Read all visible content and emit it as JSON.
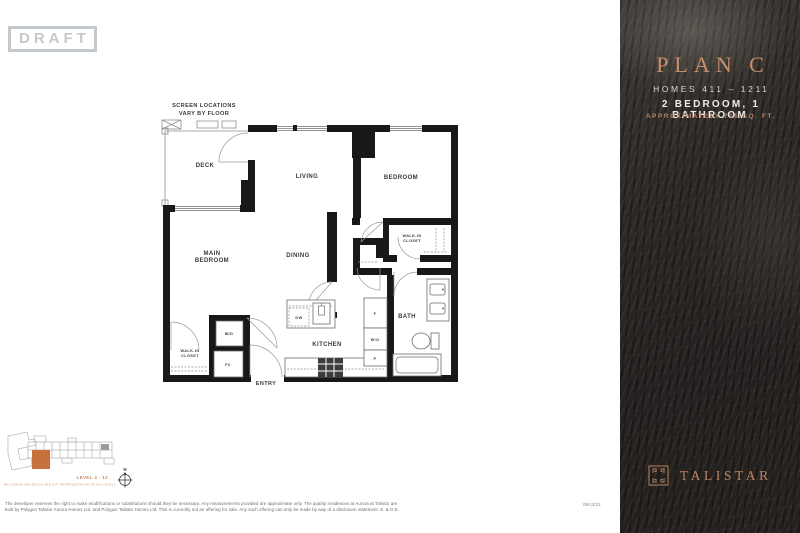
{
  "draft_label": "DRAFT",
  "colors": {
    "copper": "#C08463",
    "copper_bright": "#C98F6C",
    "unit_highlight": "#C8703C",
    "panel_bg": "#2B2825",
    "draft_gray": "#C4C9CD",
    "wall_black": "#181818"
  },
  "floorplan": {
    "note_line1": "SCREEN LOCATIONS",
    "note_line2": "VARY BY FLOOR",
    "labels": {
      "deck": "DECK",
      "living": "LIVING",
      "bedroom": "BEDROOM",
      "main_bedroom_1": "MAIN",
      "main_bedroom_2": "BEDROOM",
      "dining": "DINING",
      "kitchen": "KITCHEN",
      "bath": "BATH",
      "entry": "ENTRY",
      "walkin_bedroom_1": "WALK-IN",
      "walkin_bedroom_2": "CLOSET",
      "walkin_main_1": "WALK-IN",
      "walkin_main_2": "CLOSET",
      "wd": "W/D",
      "fc": "FC",
      "dw": "DW",
      "fridge": "F",
      "wall_oven": "W/O",
      "pantry": "P"
    }
  },
  "keyplan": {
    "level_label": "LEVEL 4 - 12",
    "note": "BALCONIES AND DECKS ARE NOT REPRESENTATIVE OF ALL LEVELS",
    "compass_n": "N"
  },
  "panel": {
    "plan_name": "PLAN C",
    "homes": "HOMES 411 – 1211",
    "bed_bath": "2 BEDROOM, 1 BATHROOM",
    "area": "APPROXIMATELY 715 SQ. FT.",
    "brand": "TALISTAR"
  },
  "footer": {
    "disclaimer_line1": "The developer reserves the right to make modifications or substitutions should they be necessary. Any measurements provided are approximate only. The quality residences at Aurora at Talistar are",
    "disclaimer_line2": "built by Polygon Talistar Aurora Homes Ltd. and Polygon Talistar Homes Ltd. This is currently not an offering for sale. Any such offering can only be made by way of a disclosure statement. E. & O.E.",
    "date": "09/13/23"
  }
}
